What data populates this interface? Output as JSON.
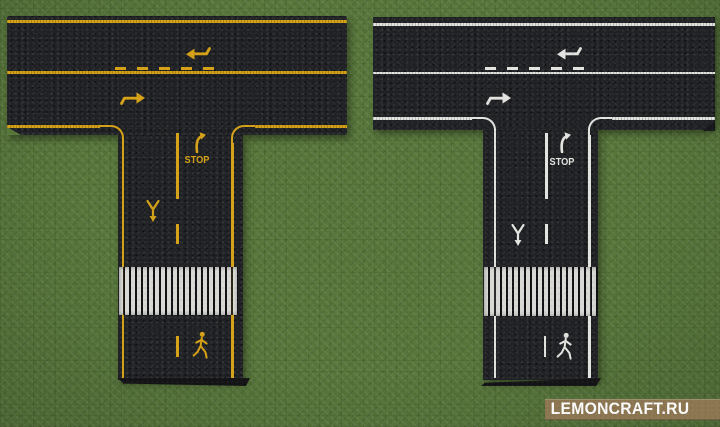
{
  "roads": {
    "left": {
      "marking_color_name": "yellow",
      "stop_label": "STOP",
      "markings": [
        "edge-lines",
        "center-line-solid",
        "center-line-dashed",
        "turn-right-arrow",
        "stop-text",
        "yield-ahead",
        "crosswalk-zebra",
        "pedestrian-crossing",
        "lane-merge-arrows"
      ]
    },
    "right": {
      "marking_color_name": "white",
      "stop_label": "STOP",
      "markings": [
        "edge-lines",
        "center-line-solid",
        "center-line-dashed",
        "turn-right-arrow",
        "stop-text",
        "yield-ahead",
        "crosswalk-zebra",
        "pedestrian-crossing",
        "lane-merge-arrows"
      ]
    }
  },
  "watermark": {
    "text": "LEMONCRAFT.RU"
  },
  "icons": {
    "turn_arrow": "turn-right-curve-arrow-icon",
    "yield": "yield-ahead-icon",
    "pedestrian": "pedestrian-walking-icon",
    "lane_arrow_left": "lane-arrow-left-icon",
    "lane_arrow_right": "lane-arrow-right-icon"
  },
  "colors": {
    "grass": "#57763a",
    "asphalt": "#202124",
    "marking_yellow": "#d4a117",
    "marking_white": "#e3e3e0",
    "crosswalk_white": "#d8d8d5",
    "watermark_bg": "#8c7651",
    "watermark_text": "#fbfbfb"
  }
}
